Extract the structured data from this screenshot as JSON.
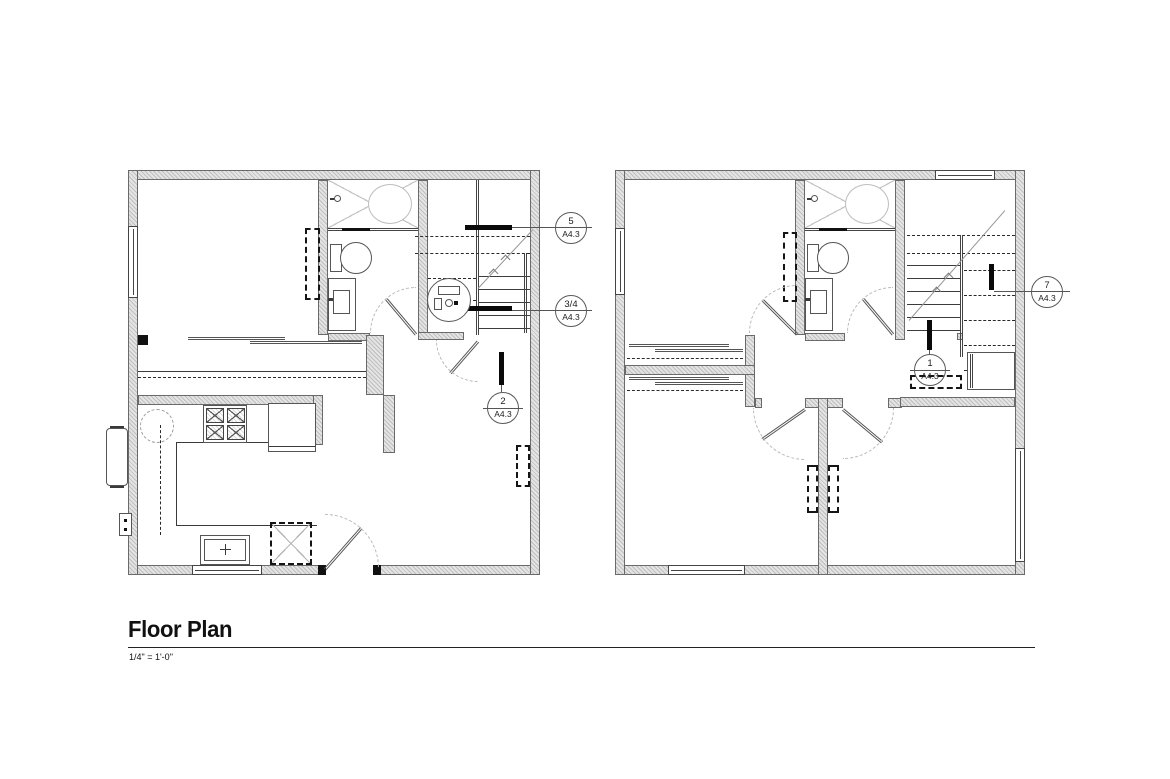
{
  "drawing": {
    "title": "Floor Plan",
    "scale": "1/4\" = 1'-0\"",
    "callouts": {
      "detail5": {
        "number": "5",
        "sheet": "A4.3"
      },
      "detail34": {
        "number": "3/4",
        "sheet": "A4.3"
      },
      "detail2": {
        "number": "2",
        "sheet": "A4.3"
      },
      "detail1": {
        "number": "1",
        "sheet": "A4.3"
      },
      "detail7": {
        "number": "7",
        "sheet": "A4.3"
      }
    },
    "colors": {
      "background": "#ffffff",
      "line": "#2a2a2a",
      "wall_fill": "#d9d9d9",
      "light_line": "#bbbbbb"
    }
  }
}
